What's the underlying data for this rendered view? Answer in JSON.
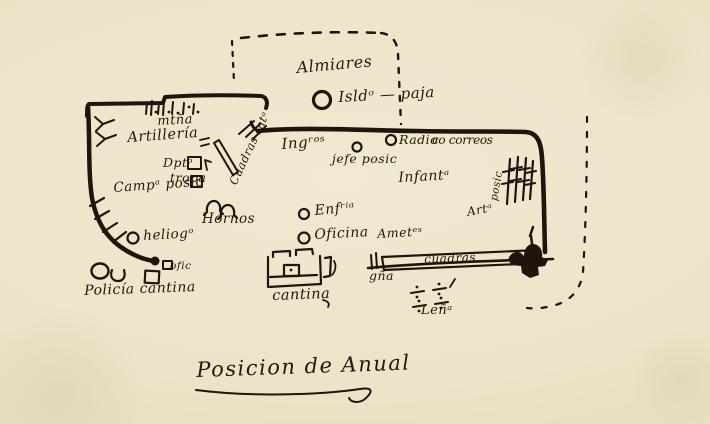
{
  "caption": "Posicion de Anual",
  "colors": {
    "paper": "#ece3c8",
    "ink": "#1e150c"
  },
  "labels": {
    "almiares": "Almiares",
    "straw": "Isldᵒ — paja",
    "ingenieros": "Ingʳᵒˢ",
    "jefe_posicion": "jefe posic",
    "radio": "Radio",
    "correos": "co correos",
    "infanteria": "Infantᵃ",
    "posicion_vertical": "posic",
    "artilleria_abbrev": "Artᵃ",
    "enfermeria": "Enfʳⁱᵃ",
    "oficina": "Oficina",
    "ametralladoras": "Ametᵉˢ",
    "montana": "mtña",
    "artilleria": "Artillería",
    "deposito": "Dptᵒ",
    "tropa": "tropa",
    "campamento": "Campᵃ posic",
    "cuadras_intendencia": "Cuadras Intᵃ",
    "hornos": "Hornos",
    "heliografo": "heliogᵒ",
    "policia_cantina": "Policía cantina",
    "oficina_small": "ofic",
    "cantina": "cantina",
    "guarnicion": "gña",
    "cuadras": "cuadras",
    "lena": "Leñᵃ"
  }
}
